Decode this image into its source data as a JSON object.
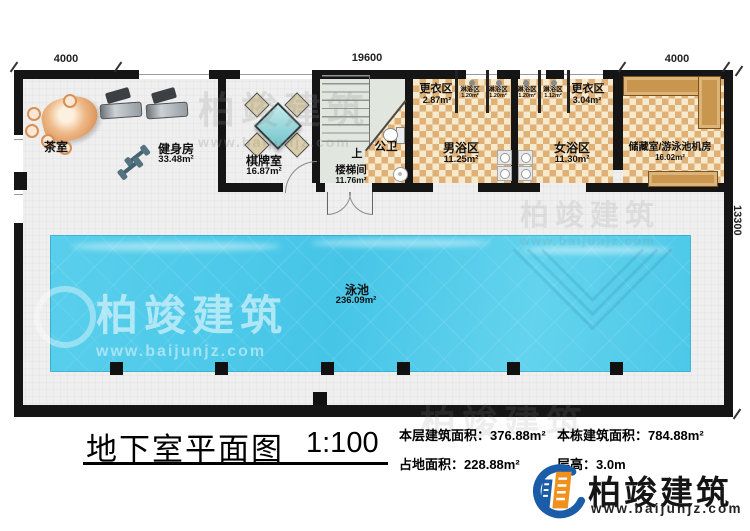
{
  "plan": {
    "dims": {
      "top_left": "4000",
      "top_center": "19600",
      "top_right": "4000",
      "right_side": "13300"
    },
    "rooms": {
      "tea": {
        "name": "茶室"
      },
      "gym": {
        "name": "健身房",
        "area": "33.48m²"
      },
      "chess": {
        "name": "棋牌室",
        "area": "16.87m²"
      },
      "stair": {
        "up": "上",
        "name": "楼梯间",
        "area": "11.76m²"
      },
      "wc": {
        "name": "公卫"
      },
      "changing_m": {
        "name": "更衣区",
        "area": "2.87m²"
      },
      "shower1": {
        "name": "淋浴区",
        "area": "1.20m²"
      },
      "shower2": {
        "name": "淋浴区",
        "area": "1.20m²"
      },
      "shower3": {
        "name": "淋浴区",
        "area": "1.20m²"
      },
      "shower4": {
        "name": "淋浴区",
        "area": "1.12m²"
      },
      "bath_m": {
        "name": "男浴区",
        "area": "11.25m²"
      },
      "bath_f": {
        "name": "女浴区",
        "area": "11.30m²"
      },
      "changing_f": {
        "name": "更衣区",
        "area": "3.04m²"
      },
      "storage": {
        "name": "储藏室/游泳池机房",
        "area": "16.02m²"
      },
      "pool": {
        "name": "泳池",
        "area": "236.09m²"
      }
    }
  },
  "footer": {
    "title": "地下室平面图",
    "scale": "1:100",
    "stats": [
      {
        "label": "本层建筑面积：",
        "value": "376.88m²"
      },
      {
        "label": "本栋建筑面积：",
        "value": "784.88m²"
      },
      {
        "label": "占地面积：",
        "value": "228.88m²"
      },
      {
        "label": "层高：",
        "value": "3.0m"
      }
    ]
  },
  "brand": {
    "name": "柏竣建筑",
    "website": "www.baijunjz.com"
  },
  "colors": {
    "wall": "#151515",
    "checker_dark": "#e0b176",
    "checker_light": "#f6e9cc",
    "pool": "#4cc8e8",
    "counter": "#c9964f",
    "brand_blue": "#1b5ca8",
    "brand_orange": "#f0901e"
  }
}
